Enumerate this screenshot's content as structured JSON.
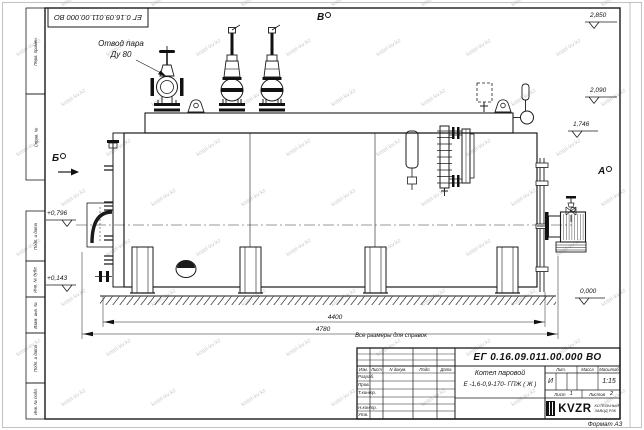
{
  "sheet": {
    "watermark": "kotel-kv.kz",
    "format_note": "Формат  А3",
    "reference_note": "Все размеры для справок",
    "doc_number_flipped": "ЕГ 0.16.09.011.00.000  ВО"
  },
  "margin_boxes": [
    "Перв. примен.",
    "Справ. №",
    "Подп. и дата",
    "Инв. № дубл.",
    "Взам. инв. №",
    "Подп. и дата",
    "Инв. № подл."
  ],
  "drawing": {
    "callout_line1": "Отвод пара",
    "callout_line2": "Ду 80",
    "views": {
      "a": "А",
      "b": "Б",
      "v": "В"
    },
    "elevations": {
      "right": [
        "2,850",
        "2,090",
        "1,746",
        "0,000"
      ],
      "left": [
        "+0,796",
        "+0,143"
      ]
    },
    "dims": {
      "frame": "4400",
      "overall": "4780"
    }
  },
  "title_block": {
    "doc_number": "ЕГ 0.16.09.011.00.000  ВО",
    "product_line1": "Котел паровой",
    "product_line2": "Е -1,6-0,9-170- ГПЖ ( Ж )",
    "col_izm": "Изм.",
    "col_list": "Лист",
    "col_doc": "N докум.",
    "col_podp": "Подп.",
    "col_data": "Дата",
    "row_razrab": "Разраб.",
    "row_prov": "Пров.",
    "row_tkontr": "Т.контр.",
    "row_nkontr": "Н.контр.",
    "row_utv": "Утв.",
    "lit_label": "Лит.",
    "lit_value": "И",
    "massa_label": "Масса",
    "scale_label": "Масштаб",
    "scale_value": "1:15",
    "sheet_label": "Лист",
    "sheet_value": "1",
    "sheets_label": "Листов",
    "sheets_value": "2",
    "logo": "KVZR",
    "logo_caption1": "КОТЕЛЬНЫЙ",
    "logo_caption2": "ЗАВОД РЗК"
  }
}
